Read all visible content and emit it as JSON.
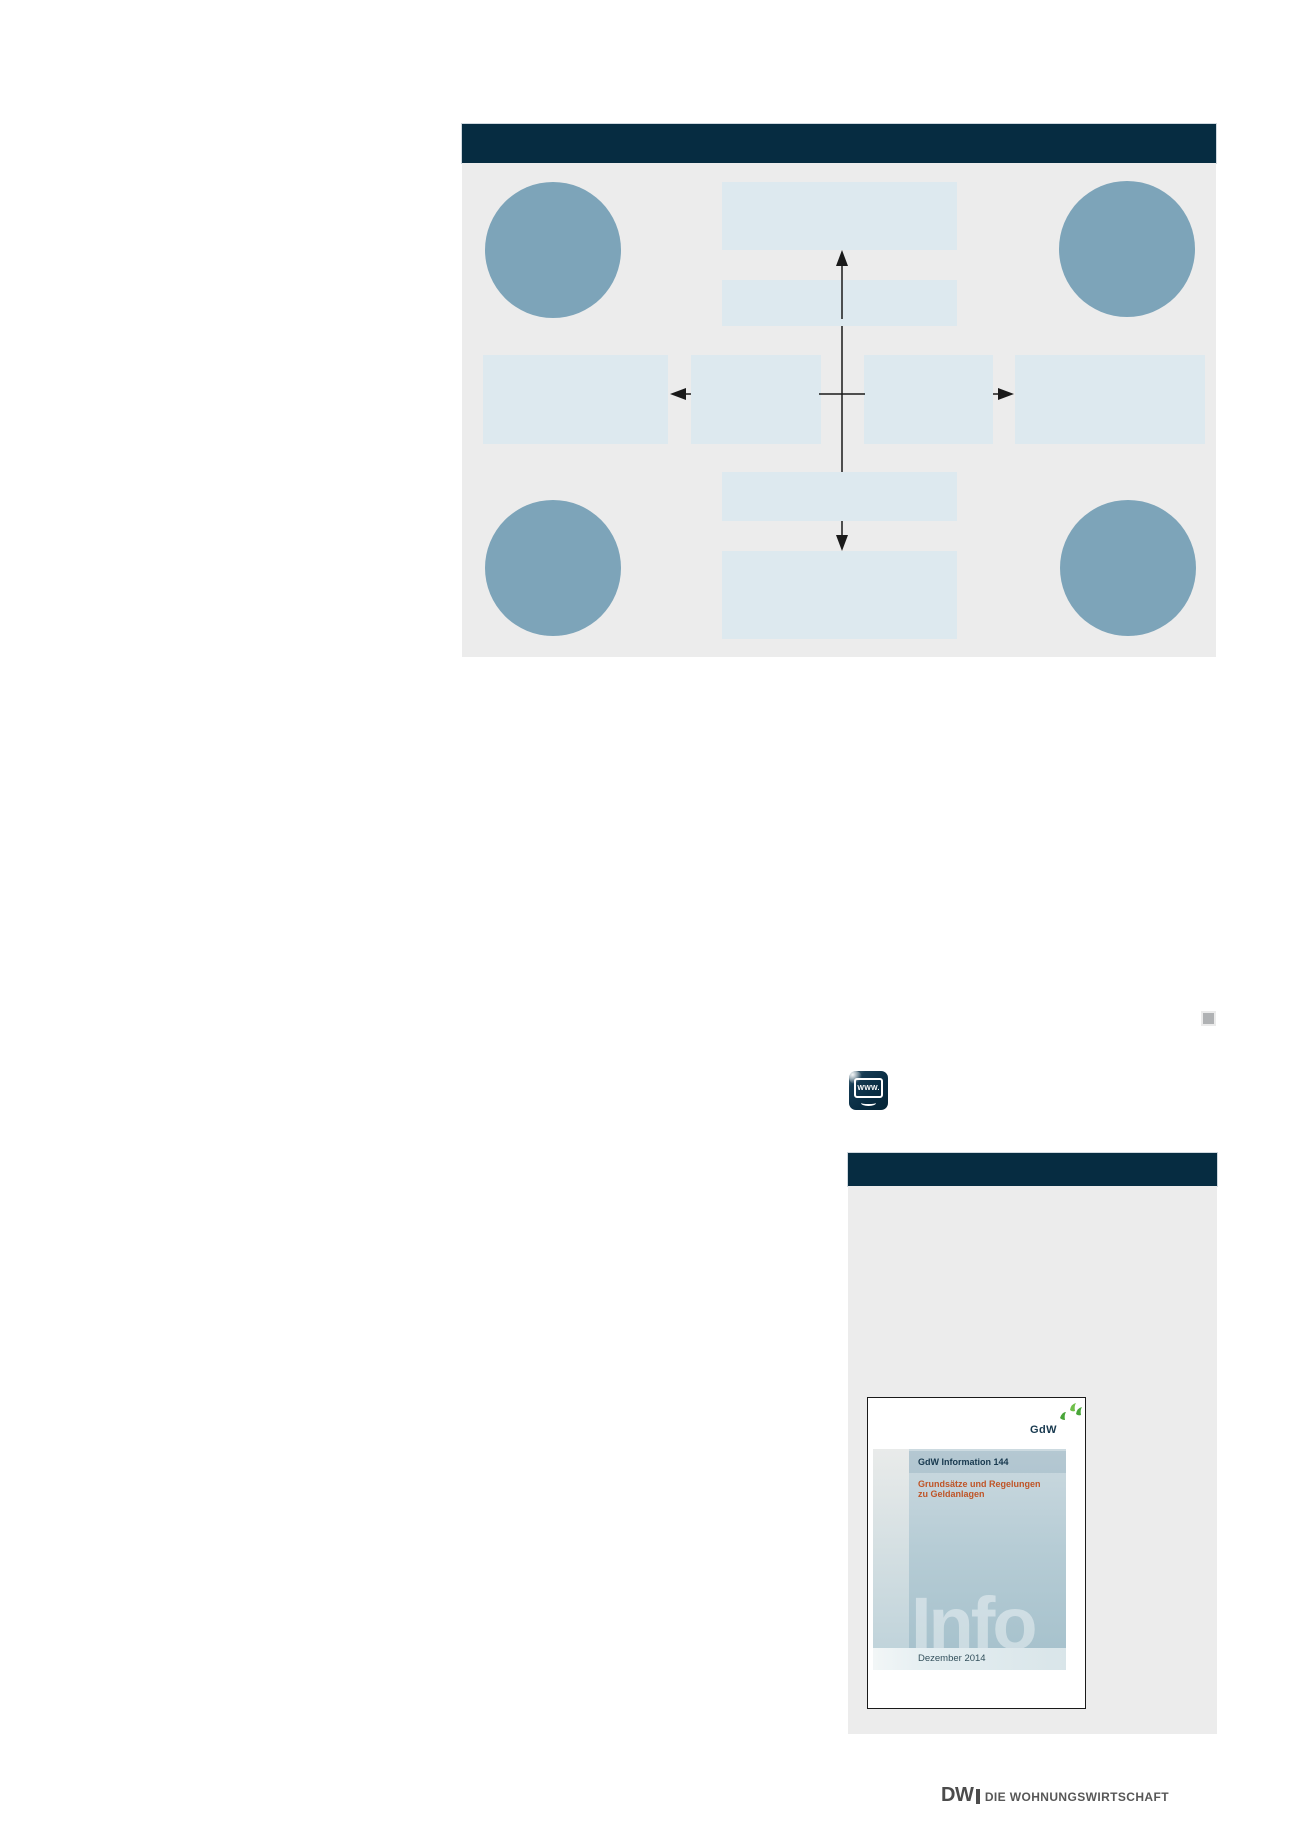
{
  "colors": {
    "navy": "#062c41",
    "panel-gray": "#ececec",
    "box-blue": "#dde9ef",
    "circle-blue": "#7da4b9",
    "arrow": "#1a1a1a",
    "orange": "#bf5426",
    "cover-navy": "#17384e",
    "logo-green-dark": "#49a539",
    "logo-green-light": "#6fbf4a",
    "footer-gray": "#4c4c4c",
    "marker-gray": "#b0b2b4",
    "date-text": "#33505c"
  },
  "www_icon": {
    "label": "WWW."
  },
  "cover": {
    "logo_text": "GdW",
    "series_label": "GdW Information 144",
    "title_line1": "Grundsätze und Regelungen",
    "title_line2": "zu Geldanlagen",
    "watermark": "Info",
    "date": "Dezember 2014"
  },
  "footer": {
    "brand": "DW",
    "title": "DIE WOHNUNGSWIRTSCHAFT"
  }
}
